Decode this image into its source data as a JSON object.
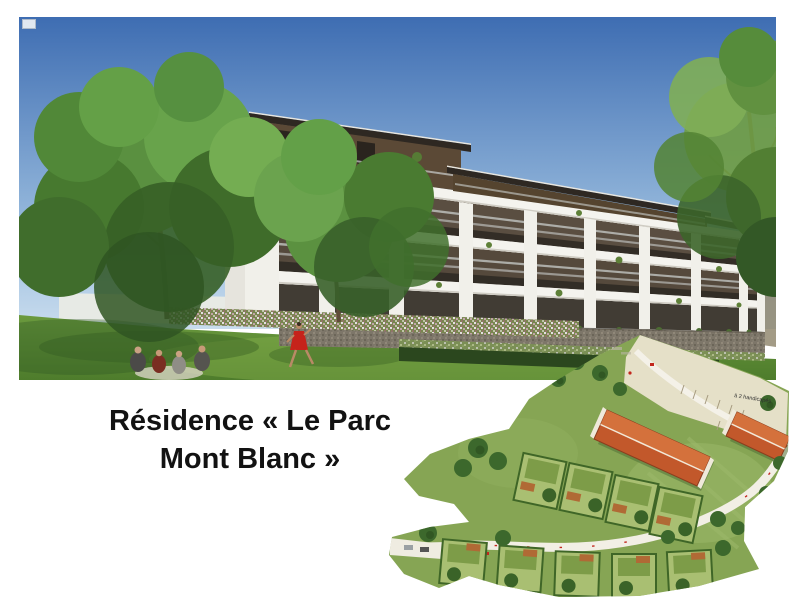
{
  "caption": {
    "line1": "Résidence « Le Parc",
    "line2": "Mont Blanc »"
  },
  "site_plan": {
    "annotations": [
      {
        "text": "à 2 handicapés"
      }
    ]
  },
  "palette": {
    "page-bg": "#ffffff",
    "caption-color": "#121212",
    "sky-top": "#3e6db2",
    "sky-bottom": "#c9dcee",
    "lawn-dark": "#4e7c2c",
    "lawn-light": "#6b9a3e",
    "building-white": "#f1f0ea",
    "balcony-shadow": "#5a4e41",
    "wood": "#5b4936",
    "roof-dark": "#2e2822",
    "stone": "#7d7669",
    "tree-green": "#4c7c33",
    "plan-grass": "#86a554",
    "plan-road": "#f2efe5",
    "plan-roof-orange": "#c2582b",
    "accent-red": "#c2271d"
  }
}
